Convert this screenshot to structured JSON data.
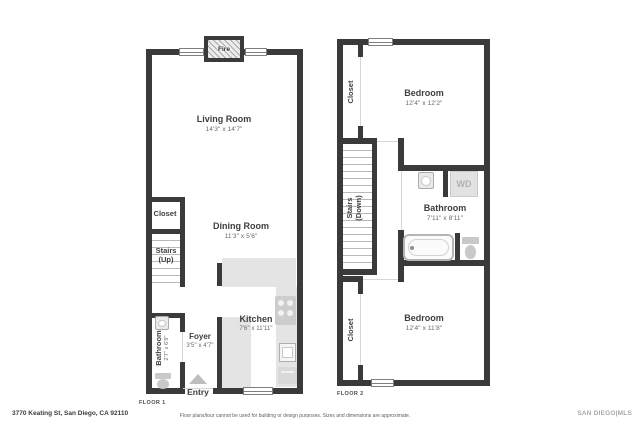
{
  "floor1": {
    "label": "FLOOR 1",
    "fireplace": "Fire",
    "living_name": "Living Room",
    "living_dims": "14'3\" x 14'7\"",
    "dining_name": "Dining Room",
    "dining_dims": "11'3\" x 5'6\"",
    "kitchen_name": "Kitchen",
    "kitchen_dims": "7'6\" x 11'11\"",
    "foyer_name": "Foyer",
    "foyer_dims": "3'5\" x 4'7\"",
    "bathroom_name": "Bathroom",
    "bathroom_dims": "2'7\" x 6'9\"",
    "closet_name": "Closet",
    "stairs_name": "Stairs (Up)",
    "entry_label": "Entry"
  },
  "floor2": {
    "label": "FLOOR 2",
    "bedroom_top_name": "Bedroom",
    "bedroom_top_dims": "12'4\" x 12'2\"",
    "bedroom_bottom_name": "Bedroom",
    "bedroom_bottom_dims": "12'4\" x 11'8\"",
    "bathroom_name": "Bathroom",
    "bathroom_dims": "7'11\" x 8'11\"",
    "closet_top_name": "Closet",
    "closet_bottom_name": "Closet",
    "stairs_name": "Stairs (Down)",
    "washer_dryer_label": "WD"
  },
  "footer": {
    "address": "3770 Keating St, San Diego, CA 92110",
    "disclaimer": "Floor plans/tour cannot be used for building or design purposes. Sizes and dimensions are approximate.",
    "brand": "SAN DIEGO|MLS"
  },
  "colors": {
    "wall": "#3a3a3a",
    "counter": "#e4e4e4",
    "fixture": "#c9c9c9",
    "stair_tread": "#b9b9b9"
  }
}
